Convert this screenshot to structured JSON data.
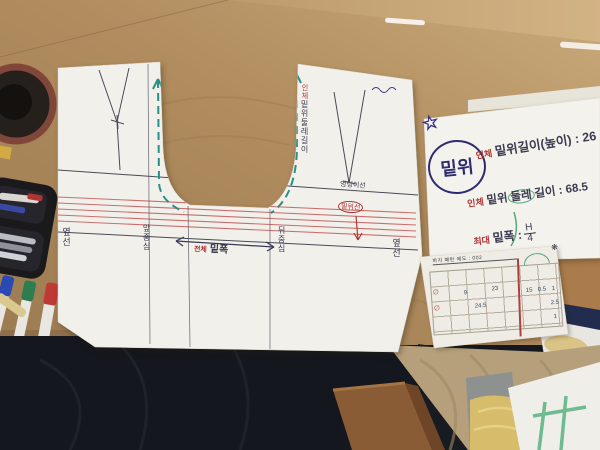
{
  "pattern_sheet": {
    "crotch_guide_prefix": "인체",
    "crotch_guide_label": "밑위둘레길이",
    "hip_line_label": "엉덩이선",
    "crotch_line_label": "밑위선",
    "side_seam_left": "옆선",
    "center_front_label": "앞중심",
    "center_back_label": "뒤중심",
    "side_seam_right": "옆선",
    "width_arrow_prefix": "전체",
    "width_arrow_label": "밑폭"
  },
  "notes_sheet": {
    "circled_title": "밑위",
    "star_glyph": "☆",
    "line1_prefix": "인체",
    "line1_text": "밑위길이(높이) : 26",
    "line2_prefix": "인체",
    "line2_part1": "밑위",
    "line2_circled": "둘레",
    "line2_part2": "길이 : 68.5",
    "line3_prefix": "최대",
    "line3_label": "밑폭 :",
    "line3_fraction_numerator": "H",
    "line3_fraction_denominator": "4"
  },
  "form_sheet": {
    "title": "바지 패턴 제도 : 002",
    "flower_mark": "❋",
    "handwritten_values": [
      "9",
      "23",
      "24.5",
      "15",
      "0.5",
      "1",
      "2.5",
      "1"
    ],
    "red_marks": [
      "∅",
      "∅"
    ]
  },
  "colors": {
    "desk_wood": "#ab8759",
    "desk_wood_light": "#c7a678",
    "paper": "#f2f0ea",
    "teal_guide": "#2a8f86",
    "red_line": "#c25858",
    "ink_dark": "#3a3a50",
    "ink_red": "#b03535",
    "ink_blue": "#2e2b70",
    "ink_green": "#58a87a"
  }
}
